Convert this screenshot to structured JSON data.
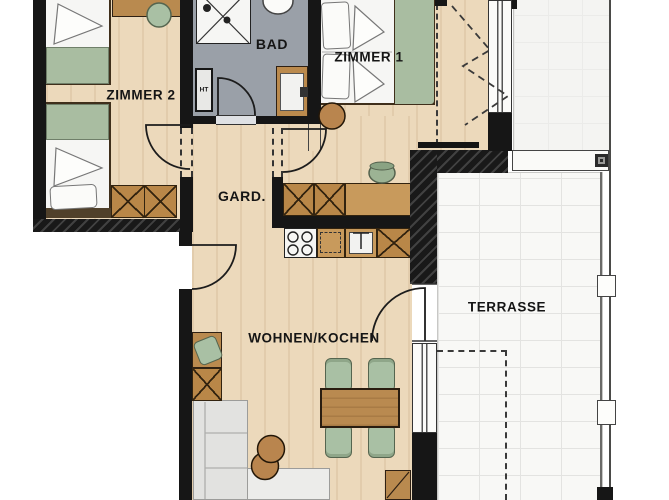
{
  "labels": {
    "zimmer2": "ZIMMER 2",
    "bad": "BAD",
    "zimmer1": "ZIMMER 1",
    "gard": "GARD.",
    "wohnen_kochen": "WOHNEN/KOCHEN",
    "terrasse": "TERRASSE",
    "ht": "HT"
  },
  "colors": {
    "wall": "#161616",
    "wood_floor": "#ecd9bb",
    "bath_floor": "#9aa0a8",
    "cabinet_wood": "#b98748",
    "counter_wood": "#c89a5c",
    "furniture_green": "#a9c0a4",
    "sofa_gray": "#e2e2e0",
    "terrace_tile": "#f8f8f6"
  },
  "furniture": {
    "zimmer2": [
      "single-bed",
      "single-bed",
      "desk",
      "desk-chair",
      "wardrobe"
    ],
    "bad": [
      "shower",
      "toilet",
      "washbasin-vanity",
      "installation-shaft"
    ],
    "zimmer1": [
      "double-bed",
      "stool"
    ],
    "kitchen": [
      "tall-cabinets",
      "counter",
      "stove",
      "dishwasher",
      "sink",
      "plant"
    ],
    "wohnen": [
      "desk",
      "desk-chair",
      "sideboard",
      "corner-sofa",
      "pouf",
      "pouf",
      "dining-table",
      "chair",
      "chair",
      "chair",
      "chair",
      "lowboard"
    ]
  }
}
